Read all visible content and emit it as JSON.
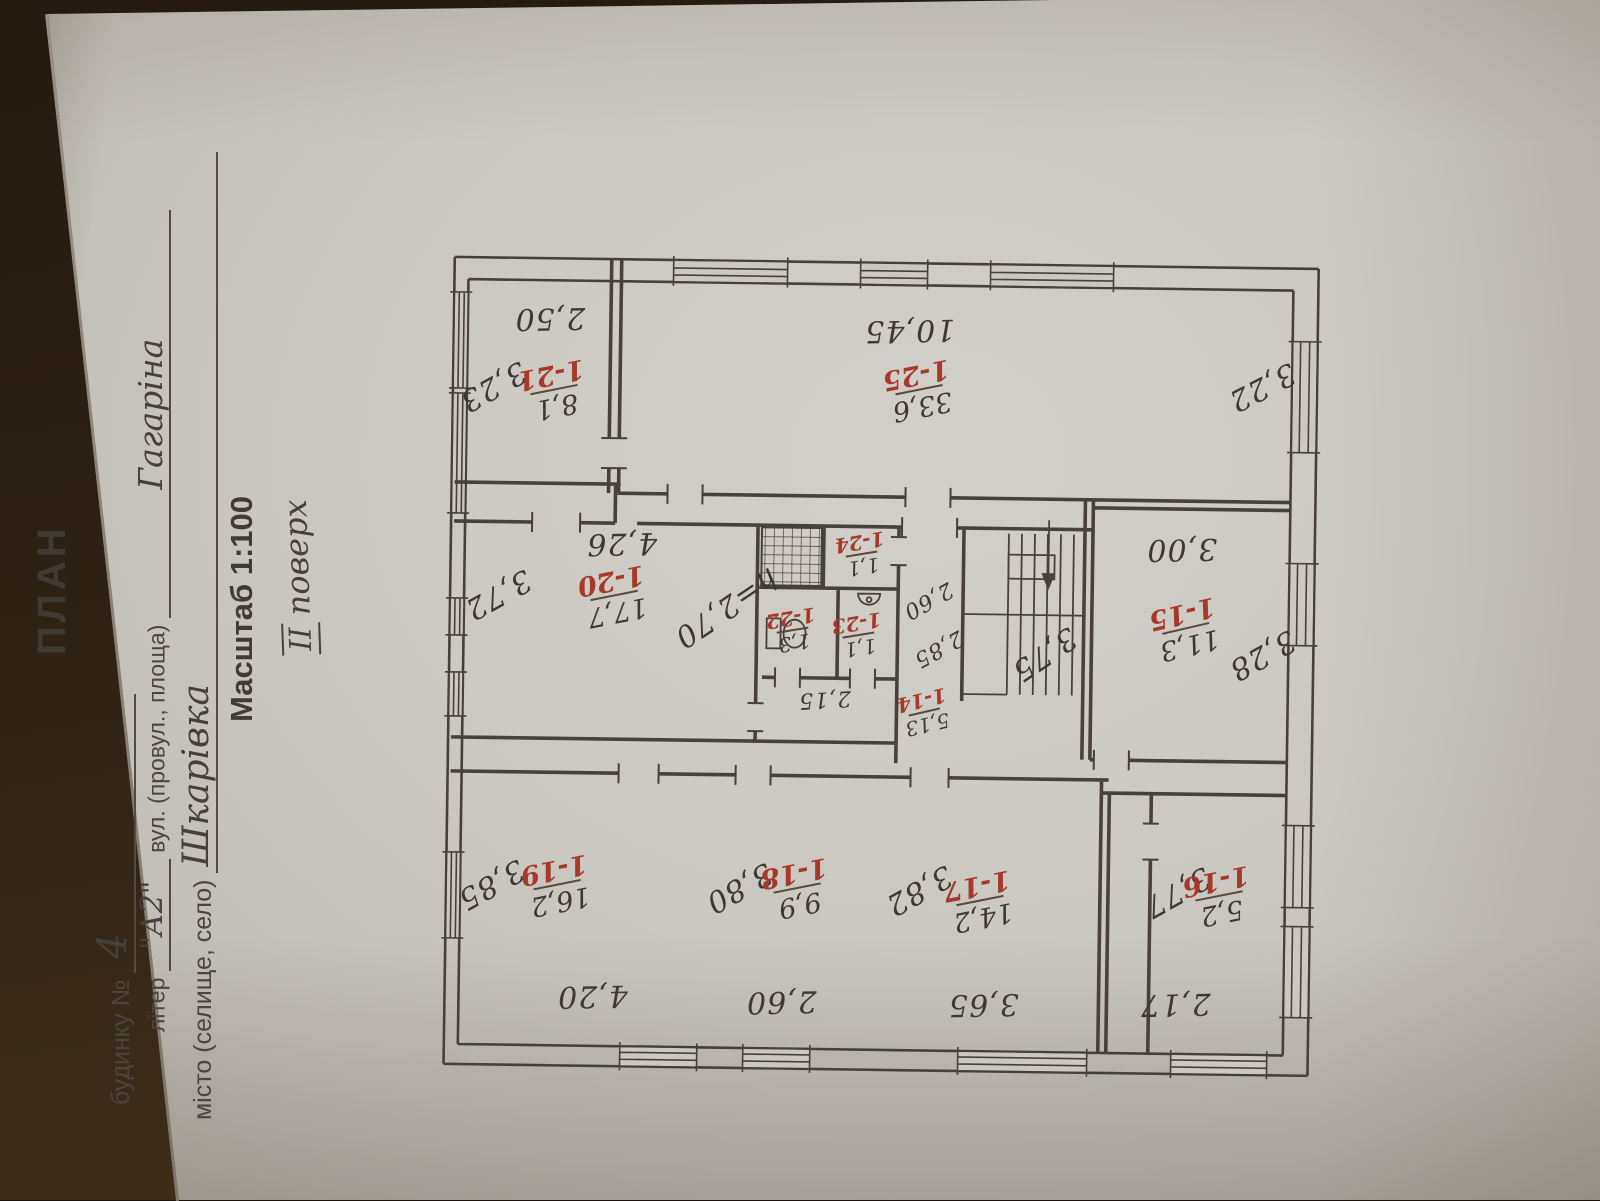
{
  "photo": {
    "background_color": "#2e2215",
    "paper_color": "#cbc8c2",
    "ink_color": "#46403a",
    "red_ink_color": "#a7392c"
  },
  "form": {
    "title": "ПЛАН",
    "line1": {
      "label": "будинку №",
      "value": "4"
    },
    "line2": {
      "label": "літер",
      "value": "\"А2\"",
      "label2": "вул. (провул., площа)",
      "value2": "Гагаріна"
    },
    "line3": {
      "label": "місто (селище, село)",
      "value": "Шкарівка"
    },
    "scale": "Масштаб 1:100",
    "floor_numeral": "ІІ",
    "floor_word": "поверх"
  },
  "plan": {
    "rooms": {
      "r14": {
        "num": "1-14",
        "area": "5,13"
      },
      "r15": {
        "num": "1-15",
        "area": "11,3"
      },
      "r16": {
        "num": "1-16",
        "area": "5,2"
      },
      "r17": {
        "num": "1-17",
        "area": "14,2"
      },
      "r18": {
        "num": "1-18",
        "area": "9,9"
      },
      "r19": {
        "num": "1-19",
        "area": "16,2"
      },
      "r20": {
        "num": "1-20",
        "area": "17,7"
      },
      "r21": {
        "num": "1-21",
        "area": "8,1"
      },
      "r22": {
        "num": "1-22",
        "area": "1,3"
      },
      "r23": {
        "num": "1-23",
        "area": "1,1"
      },
      "r24": {
        "num": "1-24",
        "area": "1,1"
      },
      "r25": {
        "num": "1-25",
        "area": "33,6"
      }
    },
    "dims": {
      "r21_top": "2,50",
      "r21_left": "3,23",
      "r25_top": "10,45",
      "r25_right": "3,22",
      "r20_top": "4,26",
      "r20_left": "3,72",
      "r20_height": "h=2,70",
      "wc_bottom": "2,15",
      "hall_w1": "2,60",
      "hall_w2": "2,85",
      "stairs": "3,75",
      "r15_top": "3,00",
      "r15_right": "3,28",
      "r19_left": "3,85",
      "r19_bottom": "4,20",
      "r18_left": "3,80",
      "r18_bottom": "2,60",
      "r17_left": "3,82",
      "r17_bottom": "3,65",
      "r16_left": "3,77",
      "r16_bottom": "2,17"
    }
  }
}
